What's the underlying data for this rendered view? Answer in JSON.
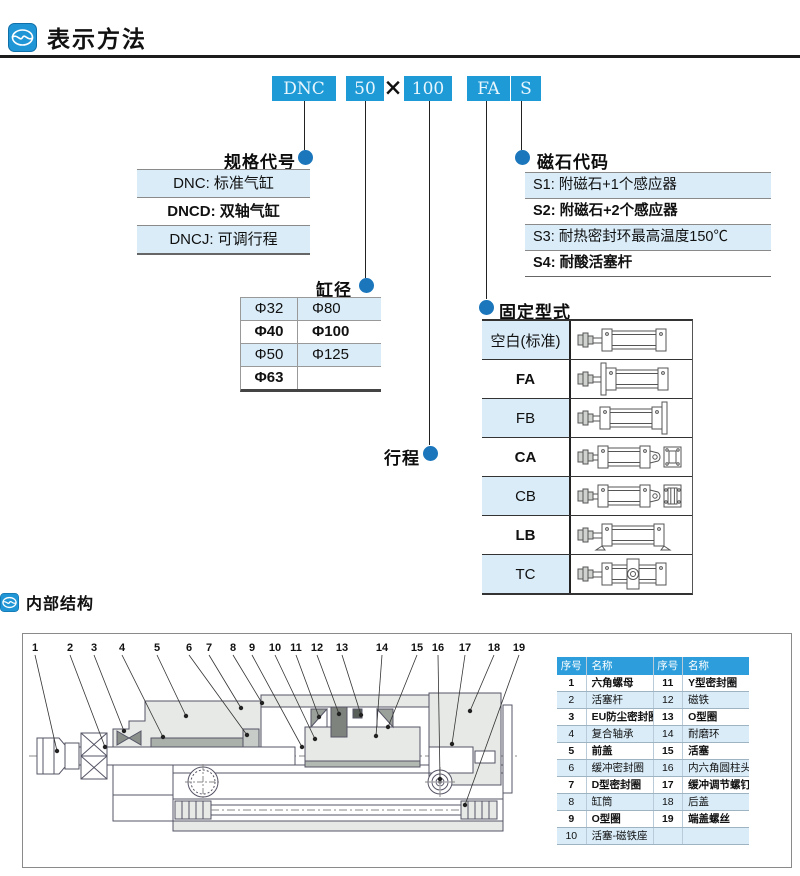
{
  "page": {
    "section1_title": "表示方法",
    "section2_title": "内部结构"
  },
  "order_code": {
    "boxes": [
      {
        "id": "model",
        "text": "DNC"
      },
      {
        "id": "bore",
        "text": "50"
      },
      {
        "id": "stroke",
        "text": "100"
      },
      {
        "id": "mount",
        "text": "FA"
      },
      {
        "id": "magnet",
        "text": "S"
      }
    ],
    "separator": "×"
  },
  "spec": {
    "label": "规格代号",
    "rows": [
      {
        "text": "DNC: 标准气缸",
        "highlight": true,
        "bold": false
      },
      {
        "text": "DNCD: 双轴气缸",
        "highlight": false,
        "bold": true
      },
      {
        "text": "DNCJ: 可调行程",
        "highlight": true,
        "bold": false
      }
    ]
  },
  "bore": {
    "label": "缸径",
    "rows": [
      {
        "left": "Φ32",
        "right": "Φ80",
        "highlight": true,
        "bold": false
      },
      {
        "left": "Φ40",
        "right": "Φ100",
        "highlight": false,
        "bold": true
      },
      {
        "left": "Φ50",
        "right": "Φ125",
        "highlight": true,
        "bold": false
      },
      {
        "left": "Φ63",
        "right": "",
        "highlight": false,
        "bold": true
      }
    ]
  },
  "stroke": {
    "label": "行程"
  },
  "magnet": {
    "label": "磁石代码",
    "rows": [
      {
        "text": "S1: 附磁石+1个感应器",
        "highlight": true,
        "bold": false
      },
      {
        "text": "S2: 附磁石+2个感应器",
        "highlight": false,
        "bold": true
      },
      {
        "text": "S3: 耐热密封环最高温度150℃",
        "highlight": true,
        "bold": false
      },
      {
        "text": "S4: 耐酸活塞杆",
        "highlight": false,
        "bold": true
      }
    ]
  },
  "mounting": {
    "label": "固定型式",
    "rows": [
      {
        "code": "空白(标准)",
        "type": "basic",
        "highlight": true,
        "bold": false
      },
      {
        "code": "FA",
        "type": "front-flange",
        "highlight": false,
        "bold": true
      },
      {
        "code": "FB",
        "type": "rear-flange",
        "highlight": true,
        "bold": false
      },
      {
        "code": "CA",
        "type": "rear-clevis",
        "highlight": false,
        "bold": true
      },
      {
        "code": "CB",
        "type": "rear-clevis-double",
        "highlight": true,
        "bold": false
      },
      {
        "code": "LB",
        "type": "foot",
        "highlight": false,
        "bold": true
      },
      {
        "code": "TC",
        "type": "trunnion",
        "highlight": true,
        "bold": false
      }
    ]
  },
  "internal": {
    "callouts": [
      "1",
      "2",
      "3",
      "4",
      "5",
      "6",
      "7",
      "8",
      "9",
      "10",
      "11",
      "12",
      "13",
      "14",
      "15",
      "16",
      "17",
      "18",
      "19"
    ],
    "parts_table": {
      "headers": [
        "序号",
        "名称",
        "序号",
        "名称"
      ],
      "rows": [
        {
          "no1": "1",
          "name1": "六角螺母",
          "no2": "11",
          "name2": "Y型密封圈",
          "highlight": false,
          "bold": true
        },
        {
          "no1": "2",
          "name1": "活塞杆",
          "no2": "12",
          "name2": "磁铁",
          "highlight": true,
          "bold": false
        },
        {
          "no1": "3",
          "name1": "EU防尘密封圈",
          "no2": "13",
          "name2": "O型圈",
          "highlight": false,
          "bold": true
        },
        {
          "no1": "4",
          "name1": "复合轴承",
          "no2": "14",
          "name2": "耐磨环",
          "highlight": true,
          "bold": false
        },
        {
          "no1": "5",
          "name1": "前盖",
          "no2": "15",
          "name2": "活塞",
          "highlight": false,
          "bold": true
        },
        {
          "no1": "6",
          "name1": "缓冲密封圈",
          "no2": "16",
          "name2": "内六角圆柱头螺钉",
          "highlight": true,
          "bold": false
        },
        {
          "no1": "7",
          "name1": "D型密封圈",
          "no2": "17",
          "name2": "缓冲调节螺钉",
          "highlight": false,
          "bold": true
        },
        {
          "no1": "8",
          "name1": "缸筒",
          "no2": "18",
          "name2": "后盖",
          "highlight": true,
          "bold": false
        },
        {
          "no1": "9",
          "name1": "O型圈",
          "no2": "19",
          "name2": "端盖螺丝",
          "highlight": false,
          "bold": true
        },
        {
          "no1": "10",
          "name1": "活塞-磁铁座",
          "no2": "",
          "name2": "",
          "highlight": true,
          "bold": false
        }
      ]
    }
  },
  "colors": {
    "accent": "#1e9bd7",
    "dot_blue": "#1b76bc",
    "row_highlight": "#d9ecf8",
    "table_header": "#2d9edb"
  }
}
